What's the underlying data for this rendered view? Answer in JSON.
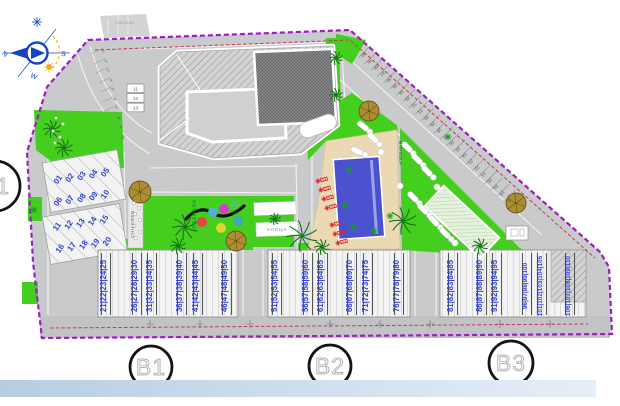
{
  "compass": {
    "n": "N",
    "s": "S",
    "w": "W"
  },
  "labels": {
    "children": "CHILDREN",
    "granada": "GRANADA",
    "minigolf": "MINIGOLF",
    "street_rect": "УЛИЦА",
    "top_note": "МАГАЗИН"
  },
  "circles": {
    "left": "B1",
    "b1": "B1",
    "b2": "B2",
    "b3": "B3"
  },
  "parking": {
    "curve_stalls": [
      "1",
      "2",
      "3",
      "4",
      "5",
      "6",
      "7",
      "8",
      "9",
      "10"
    ],
    "garage_boxes": [
      "11",
      "12",
      "13"
    ],
    "left_rows": [
      [
        "01",
        "02",
        "03",
        "04",
        "05"
      ],
      [
        "06",
        "07",
        "08",
        "09",
        "10"
      ],
      [
        "11",
        "12",
        "13",
        "14",
        "15"
      ],
      [
        "16",
        "17",
        "18",
        "19",
        "20"
      ]
    ],
    "diagonal_stalls": [
      "40",
      "39",
      "38",
      "37",
      "36",
      "35",
      "34",
      "33",
      "32",
      "31",
      "30",
      "29",
      "28",
      "27",
      "26",
      "25",
      "24",
      "23",
      "22",
      "21",
      "20",
      "19",
      "18",
      "17"
    ],
    "bottom_rows": [
      "21|22|23|24|25",
      "26|27|28|29|30",
      "31|32|33|34|35",
      "36|37|38|39|40",
      "41|42|43|44|45",
      "46|47|48|49|50",
      "51|52|53|54|55",
      "56|57|58|59|60",
      "61|62|63|64|65",
      "66|67|68|69|70",
      "71|72|73|74|75",
      "76|77|78|79|80",
      "81|82|83|84|85",
      "86|87|88|89|90",
      "91|92|93|94|95",
      "96|97|98|99|100",
      "101|102|103|104|105",
      "106|107|108|109|110"
    ]
  },
  "colors": {
    "boundary": "#9b1fc1",
    "setback": "#c23a5a",
    "numbers": "#3643cd",
    "green": "#44cf1e",
    "pool": "#4a52cf",
    "deck": "#ead9b4",
    "lounger": "#e02020",
    "site_gray": "#c9cacc"
  }
}
